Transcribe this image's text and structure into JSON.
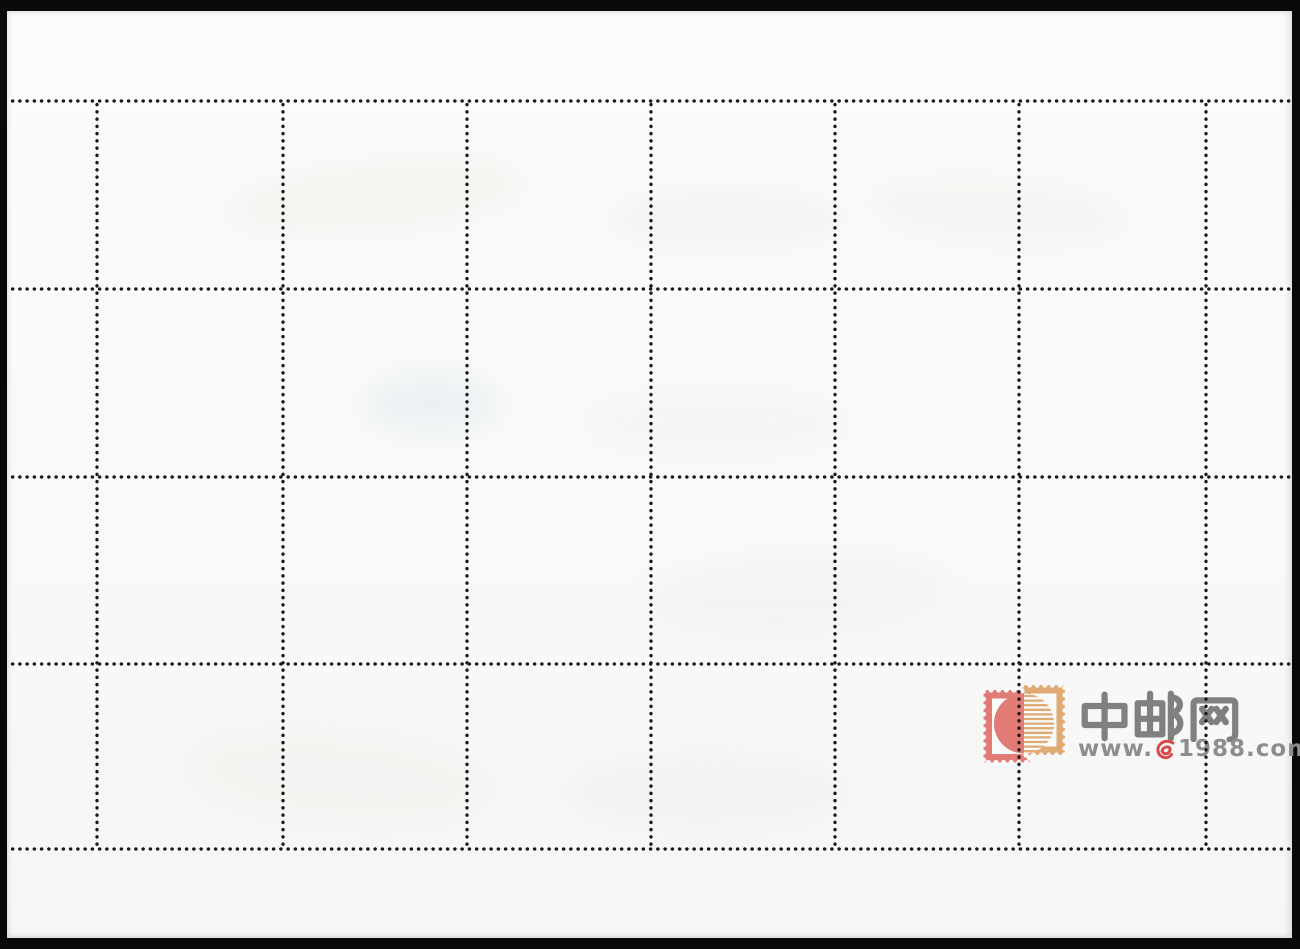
{
  "sheet": {
    "kind": "blank back of perforated stamp sheet (scan)",
    "grid": {
      "columns": 6,
      "rows": 4,
      "col_lines_x": [
        97,
        283,
        467,
        651,
        835,
        1019,
        1206
      ],
      "row_lines_y": [
        101,
        289,
        477,
        664,
        849
      ],
      "h_span": [
        9,
        1291
      ],
      "v_span": [
        101,
        849
      ],
      "dot_pitch_px": 7.25,
      "dot_diameter_px": 3.7
    }
  },
  "watermark": {
    "site_name": "中邮网",
    "url_prefix": "www.",
    "url_suffix": "1988.com",
    "logo": "overlapping-stamps-icon"
  },
  "colors": {
    "scan_background": "#090909",
    "paper": "#f8f9f8",
    "perforation_dot": "#1a1a1a",
    "logo_pink": "#e27a76",
    "logo_tan": "#e0aa74",
    "name_gray": "#7f8080",
    "url_gray": "#8d8d8d",
    "url_red": "#d94b48"
  }
}
